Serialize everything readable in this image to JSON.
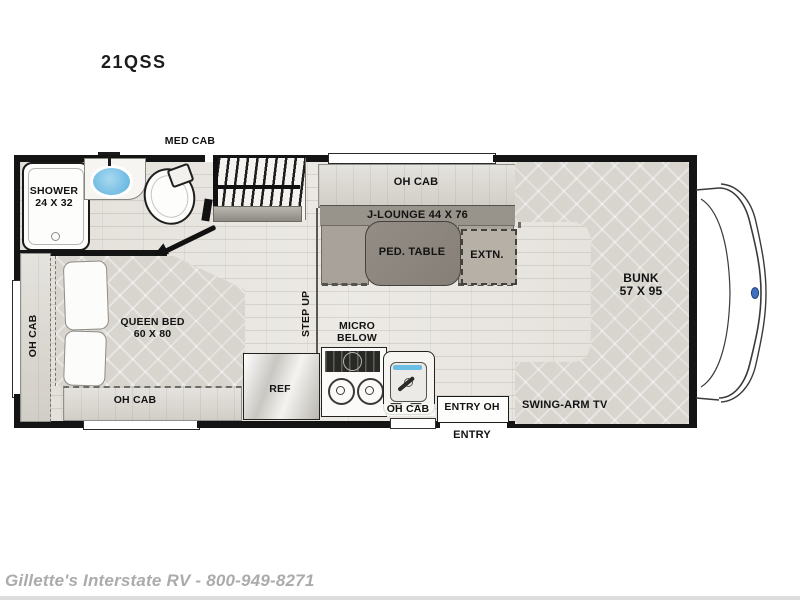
{
  "title": "21QSS",
  "footer": "Gillette's Interstate RV - 800-949-8271",
  "colors": {
    "wall": "#141414",
    "floor": "#e9e6e1",
    "mattress": "#d8d4ce",
    "cushion": "#a8a29a",
    "pedestal_table": "#8d8780",
    "sink_water": "#6bbde4",
    "cab_badge": "#3f6fbf",
    "footer_text": "#ababab"
  },
  "labels": {
    "med_cab": "MED CAB",
    "shower": "SHOWER",
    "shower_size": "24 X 32",
    "oh_cab": "OH CAB",
    "queen_bed": "QUEEN BED",
    "queen_bed_size": "60 X 80",
    "step_up": "STEP UP",
    "micro": "MICRO",
    "below": "BELOW",
    "ref": "REF",
    "entry_oh": "ENTRY OH",
    "entry": "ENTRY",
    "j_lounge": "J-LOUNGE 44 X 76",
    "ped_table": "PED. TABLE",
    "extn": "EXTN.",
    "bunk": "BUNK",
    "bunk_size": "57 X 95",
    "swing_arm_tv": "SWING-ARM TV"
  }
}
